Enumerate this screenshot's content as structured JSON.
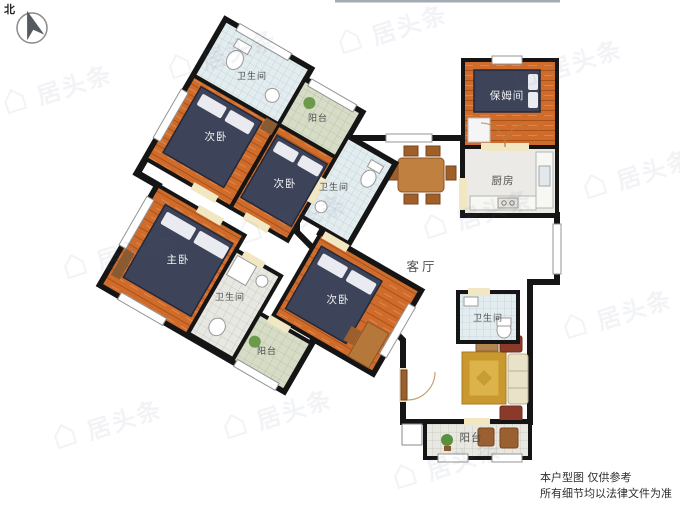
{
  "compass": {
    "label": "北"
  },
  "rooms": [
    {
      "id": "bathroom-top",
      "label": "卫生间"
    },
    {
      "id": "bedroom-1",
      "label": "次卧"
    },
    {
      "id": "balcony-top",
      "label": "阳台"
    },
    {
      "id": "bedroom-2",
      "label": "次卧"
    },
    {
      "id": "bathroom-mid",
      "label": "卫生间"
    },
    {
      "id": "master-bedroom",
      "label": "主卧"
    },
    {
      "id": "bathroom-left",
      "label": "卫生间"
    },
    {
      "id": "balcony-left",
      "label": "阳台"
    },
    {
      "id": "bedroom-3",
      "label": "次卧"
    },
    {
      "id": "living-room",
      "label": "客厅"
    },
    {
      "id": "nanny-room",
      "label": "保姆间"
    },
    {
      "id": "kitchen",
      "label": "厨房"
    },
    {
      "id": "bathroom-right",
      "label": "卫生间"
    },
    {
      "id": "balcony-bottom",
      "label": "阳台"
    }
  ],
  "disclaimer": {
    "line1": "本户型图 仅供参考",
    "line2": "所有细节均以法律文件为准"
  },
  "watermark": {
    "text": "居头条"
  },
  "colors": {
    "wall": "#151515",
    "bedroom_floor": "#d06c2b",
    "living_floor": "#f2e7c3",
    "bath_tile": "#e3ecef",
    "balcony_tile_green": "#d6dcc6",
    "balcony_tile_gray": "#dcdcd4",
    "kitchen_floor": "#eceae6",
    "bed": "#3d4358",
    "rug": "#c9992f",
    "wood_furniture": "#b5773a"
  }
}
